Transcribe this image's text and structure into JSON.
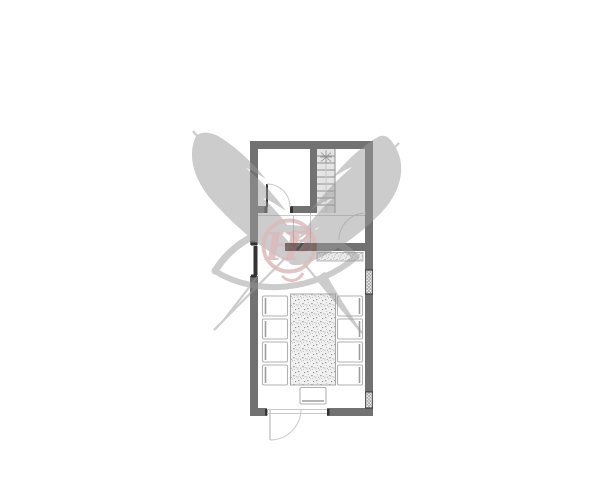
{
  "page": {
    "background": "#ffffff",
    "kind": "architectural floor plan with studio watermark"
  },
  "palette": {
    "background": "#ffffff",
    "wall": "#727272",
    "wall_dark": "#4d4d4d",
    "door_leaf": "#333333",
    "line": "#8f8f8f",
    "faint": "#c8c8c8",
    "chair": "#b2b2b2",
    "chair_dark": "#9c9c9c",
    "stair_fill": "#e4e4e4",
    "watermark_gray": "#9b9b9b",
    "watermark_red": "#b97878"
  },
  "watermark": {
    "monogram": "HB",
    "monogram_h": "H",
    "monogram_b": "B"
  },
  "plan": {
    "outer": {
      "x": 250,
      "y": 141,
      "w": 123,
      "h": 275,
      "wall_thickness": 8
    },
    "stair": {
      "x": 317,
      "y": 149,
      "w": 18,
      "h": 64,
      "tread_start_y": 156,
      "tread_step": 7,
      "tread_count": 8
    },
    "counter": {
      "x": 317,
      "y": 252.5,
      "w": 46,
      "h": 8.5
    },
    "table": {
      "x": 290.5,
      "y": 294,
      "w": 45,
      "h": 91
    },
    "chairs": {
      "side_w": 25,
      "side_h": 20,
      "left_x": 262.5,
      "right_x": 337.5,
      "row_ys": [
        296,
        319,
        342,
        365
      ],
      "bottom": {
        "x": 300,
        "y": 387.5,
        "w": 26,
        "h": 16.5
      }
    },
    "windows": [
      {
        "x": 365.5,
        "y": 270,
        "w": 7,
        "h": 24
      },
      {
        "x": 365.5,
        "y": 392,
        "w": 7,
        "h": 16
      }
    ]
  }
}
